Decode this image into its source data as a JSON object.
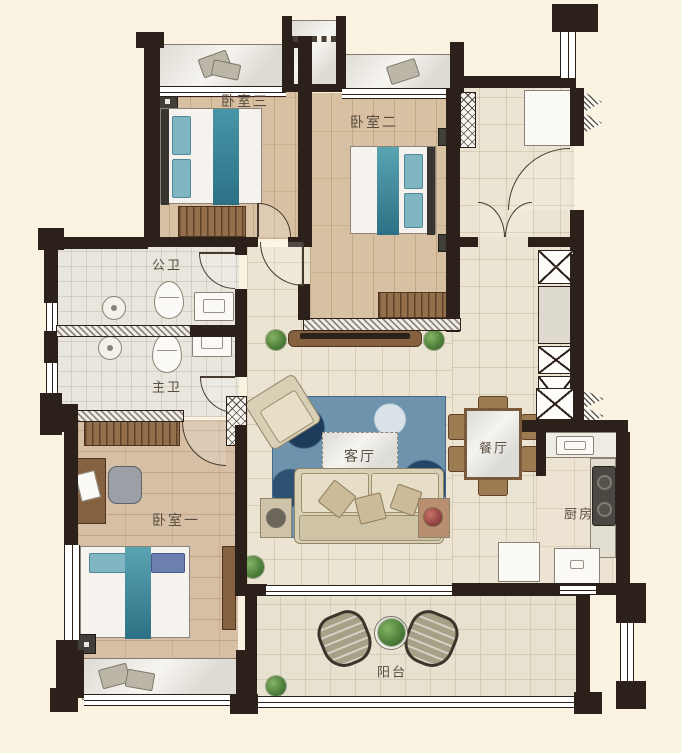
{
  "rooms": {
    "bedroom3": {
      "label": "卧室三"
    },
    "bedroom2": {
      "label": "卧室二"
    },
    "bedroom1": {
      "label": "卧室一"
    },
    "public_bathroom": {
      "label": "公卫"
    },
    "master_bathroom": {
      "label": "主卫"
    },
    "living_room": {
      "label": "客厅"
    },
    "dining_room": {
      "label": "餐厅"
    },
    "kitchen": {
      "label": "厨房"
    },
    "balcony": {
      "label": "阳台"
    }
  },
  "colors": {
    "background": "#fbf3e1",
    "wall": "#2b211a",
    "label": "#5a4e40",
    "wood_floor": "#d8c0a2",
    "tile_floor": "#ece4d2",
    "bath_floor": "#e9e6de",
    "balcony_floor": "#e7e1d0",
    "rug_blue": "#6e93ad",
    "accent_teal": "#3f8b9b",
    "furniture_beige": "#d9cfb4",
    "furniture_wood": "#946f4b"
  }
}
